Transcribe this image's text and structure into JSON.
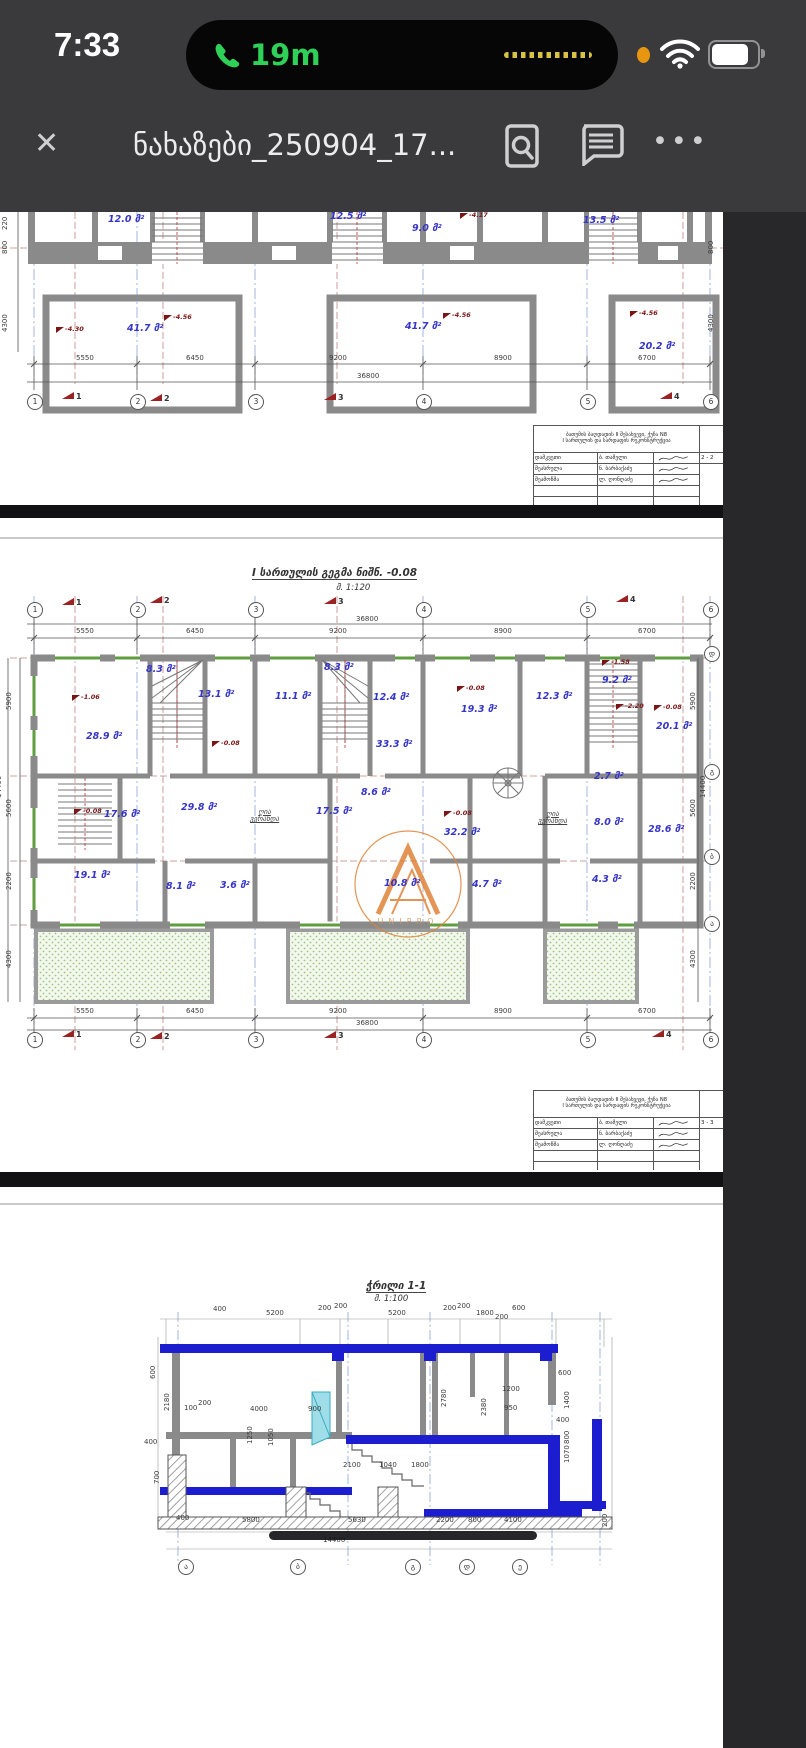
{
  "status_bar": {
    "time": "7:33",
    "call_duration": "19m",
    "call_color": "#2fd058",
    "mic_indicator_color": "#e8960f",
    "battery_level": "76%"
  },
  "toolbar": {
    "close_glyph": "✕",
    "title": "ნახაზები_250904_17...",
    "more_glyph": "•••",
    "icons": [
      "search-in-document",
      "comments",
      "more-options"
    ]
  },
  "viewer": {
    "page_color": "#ffffff",
    "gap_color": "#121214",
    "chrome_color": "#3a3a3c",
    "accent_blue": "#3535c8",
    "wall_gray": "#8a8a8a",
    "window_green": "#5f9e3f",
    "watermark_orange": "#e08238",
    "section_blue": "#1d1dd0"
  },
  "pages": [
    {
      "name": "basement-plan-partial",
      "labels": [
        {
          "k": "area",
          "t": "12.0 მ²",
          "x": 108,
          "y": 3
        },
        {
          "k": "area",
          "t": "12.5 მ²",
          "x": 330,
          "y": 0
        },
        {
          "k": "area",
          "t": "9.0 მ²",
          "x": 412,
          "y": 12
        },
        {
          "k": "area",
          "t": "13.5 მ²",
          "x": 583,
          "y": 4
        },
        {
          "k": "area",
          "t": "41.7 მ²",
          "x": 127,
          "y": 112
        },
        {
          "k": "area",
          "t": "41.7 მ²",
          "x": 405,
          "y": 110
        },
        {
          "k": "area",
          "t": "20.2 მ²",
          "x": 639,
          "y": 130
        },
        {
          "k": "elev",
          "t": "-4.30",
          "x": 56,
          "y": 114
        },
        {
          "k": "elev",
          "t": "-4.56",
          "x": 164,
          "y": 102
        },
        {
          "k": "elev",
          "t": "-4.56",
          "x": 443,
          "y": 100
        },
        {
          "k": "elev",
          "t": "-4.56",
          "x": 630,
          "y": 98
        },
        {
          "k": "elev",
          "t": "-4.17",
          "x": 460,
          "y": 0
        },
        {
          "k": "dim",
          "t": "5550",
          "x": 76,
          "y": 143
        },
        {
          "k": "dim",
          "t": "6450",
          "x": 186,
          "y": 143
        },
        {
          "k": "dim",
          "t": "9200",
          "x": 329,
          "y": 143
        },
        {
          "k": "dim",
          "t": "8900",
          "x": 494,
          "y": 143
        },
        {
          "k": "dim",
          "t": "6700",
          "x": 638,
          "y": 143
        },
        {
          "k": "dim",
          "t": "36800",
          "x": 357,
          "y": 161
        },
        {
          "k": "bub",
          "t": "1",
          "x": 27,
          "y": 182
        },
        {
          "k": "bub",
          "t": "2",
          "x": 130,
          "y": 182
        },
        {
          "k": "bub",
          "t": "3",
          "x": 248,
          "y": 182
        },
        {
          "k": "bub",
          "t": "4",
          "x": 416,
          "y": 182
        },
        {
          "k": "bub",
          "t": "5",
          "x": 580,
          "y": 182
        },
        {
          "k": "bub",
          "t": "6",
          "x": 703,
          "y": 182
        },
        {
          "k": "flag",
          "t": "1",
          "x": 62,
          "y": 180
        },
        {
          "k": "flag",
          "t": "2",
          "x": 150,
          "y": 182
        },
        {
          "k": "flag",
          "t": "3",
          "x": 324,
          "y": 181
        },
        {
          "k": "flag",
          "t": "4",
          "x": 660,
          "y": 180
        },
        {
          "k": "dimv",
          "t": "220",
          "x": 2,
          "y": 18
        },
        {
          "k": "dimv",
          "t": "800",
          "x": 2,
          "y": 42
        },
        {
          "k": "dimv",
          "t": "4300",
          "x": 2,
          "y": 120
        },
        {
          "k": "dimv",
          "t": "800",
          "x": 708,
          "y": 42
        },
        {
          "k": "dimv",
          "t": "4300",
          "x": 708,
          "y": 120
        }
      ]
    },
    {
      "name": "first-floor-plan",
      "watermark": "UNIPRO",
      "labels": [
        {
          "k": "title",
          "t": "I სართულის გეგმა ნიშნ. -0.08",
          "x": 252,
          "y": 50
        },
        {
          "k": "scale",
          "t": "მ. 1:120",
          "x": 336,
          "y": 66
        },
        {
          "k": "flag",
          "t": "1",
          "x": 62,
          "y": 80
        },
        {
          "k": "flag",
          "t": "2",
          "x": 150,
          "y": 78
        },
        {
          "k": "flag",
          "t": "3",
          "x": 324,
          "y": 79
        },
        {
          "k": "flag",
          "t": "4",
          "x": 616,
          "y": 77
        },
        {
          "k": "bub",
          "t": "1",
          "x": 27,
          "y": 84
        },
        {
          "k": "bub",
          "t": "2",
          "x": 130,
          "y": 84
        },
        {
          "k": "bub",
          "t": "3",
          "x": 248,
          "y": 84
        },
        {
          "k": "bub",
          "t": "4",
          "x": 416,
          "y": 84
        },
        {
          "k": "bub",
          "t": "5",
          "x": 580,
          "y": 84
        },
        {
          "k": "bub",
          "t": "6",
          "x": 703,
          "y": 84
        },
        {
          "k": "dim",
          "t": "5550",
          "x": 76,
          "y": 110
        },
        {
          "k": "dim",
          "t": "6450",
          "x": 186,
          "y": 110
        },
        {
          "k": "dim",
          "t": "9200",
          "x": 329,
          "y": 110
        },
        {
          "k": "dim",
          "t": "8900",
          "x": 494,
          "y": 110
        },
        {
          "k": "dim",
          "t": "6700",
          "x": 638,
          "y": 110
        },
        {
          "k": "dim",
          "t": "36800",
          "x": 356,
          "y": 98
        },
        {
          "k": "elev",
          "t": "-1.06",
          "x": 72,
          "y": 176
        },
        {
          "k": "area",
          "t": "28.9 მ²",
          "x": 86,
          "y": 214
        },
        {
          "k": "area",
          "t": "8.3 მ²",
          "x": 146,
          "y": 147
        },
        {
          "k": "area",
          "t": "13.1 მ²",
          "x": 198,
          "y": 172
        },
        {
          "k": "area",
          "t": "11.1 მ²",
          "x": 275,
          "y": 174
        },
        {
          "k": "area",
          "t": "8.3 მ²",
          "x": 324,
          "y": 145
        },
        {
          "k": "area",
          "t": "12.4 მ²",
          "x": 373,
          "y": 175
        },
        {
          "k": "elev",
          "t": "-0.08",
          "x": 457,
          "y": 167
        },
        {
          "k": "area",
          "t": "19.3 მ²",
          "x": 461,
          "y": 187
        },
        {
          "k": "area",
          "t": "12.3 მ²",
          "x": 536,
          "y": 174
        },
        {
          "k": "elev",
          "t": "-1.58",
          "x": 602,
          "y": 141
        },
        {
          "k": "area",
          "t": "9.2 მ²",
          "x": 602,
          "y": 158
        },
        {
          "k": "elev",
          "t": "-2.20",
          "x": 616,
          "y": 185
        },
        {
          "k": "elev",
          "t": "-0.08",
          "x": 654,
          "y": 186
        },
        {
          "k": "area",
          "t": "20.1 მ²",
          "x": 656,
          "y": 204
        },
        {
          "k": "area",
          "t": "33.3 მ²",
          "x": 376,
          "y": 222
        },
        {
          "k": "elev",
          "t": "-0.08",
          "x": 212,
          "y": 222
        },
        {
          "k": "elev",
          "t": "-0.08",
          "x": 74,
          "y": 290
        },
        {
          "k": "area",
          "t": "17.6 მ²",
          "x": 104,
          "y": 292
        },
        {
          "k": "area",
          "t": "29.8 მ²",
          "x": 181,
          "y": 285
        },
        {
          "k": "area",
          "t": "17.5 მ²",
          "x": 316,
          "y": 289
        },
        {
          "k": "area",
          "t": "8.6 მ²",
          "x": 361,
          "y": 270
        },
        {
          "k": "elev",
          "t": "-0.08",
          "x": 444,
          "y": 292
        },
        {
          "k": "area",
          "t": "32.2 მ²",
          "x": 444,
          "y": 310
        },
        {
          "k": "note",
          "t": "ღია\nვერანდა",
          "x": 250,
          "y": 291
        },
        {
          "k": "note",
          "t": "ღია\nვერანდა",
          "x": 538,
          "y": 293
        },
        {
          "k": "area",
          "t": "2.7 მ²",
          "x": 594,
          "y": 254
        },
        {
          "k": "area",
          "t": "8.0 მ²",
          "x": 594,
          "y": 300
        },
        {
          "k": "area",
          "t": "28.6 მ²",
          "x": 648,
          "y": 307
        },
        {
          "k": "area",
          "t": "19.1 მ²",
          "x": 74,
          "y": 353
        },
        {
          "k": "area",
          "t": "8.1 მ²",
          "x": 166,
          "y": 364
        },
        {
          "k": "area",
          "t": "3.6 მ²",
          "x": 220,
          "y": 363
        },
        {
          "k": "area",
          "t": "10.8 მ²",
          "x": 384,
          "y": 361
        },
        {
          "k": "area",
          "t": "4.7 მ²",
          "x": 472,
          "y": 362
        },
        {
          "k": "area",
          "t": "4.3 მ²",
          "x": 592,
          "y": 357
        },
        {
          "k": "dim",
          "t": "5550",
          "x": 76,
          "y": 490
        },
        {
          "k": "dim",
          "t": "6450",
          "x": 186,
          "y": 490
        },
        {
          "k": "dim",
          "t": "9200",
          "x": 329,
          "y": 490
        },
        {
          "k": "dim",
          "t": "8900",
          "x": 494,
          "y": 490
        },
        {
          "k": "dim",
          "t": "6700",
          "x": 638,
          "y": 490
        },
        {
          "k": "dim",
          "t": "36800",
          "x": 356,
          "y": 502
        },
        {
          "k": "bub",
          "t": "1",
          "x": 27,
          "y": 514
        },
        {
          "k": "bub",
          "t": "2",
          "x": 130,
          "y": 514
        },
        {
          "k": "bub",
          "t": "3",
          "x": 248,
          "y": 514
        },
        {
          "k": "bub",
          "t": "4",
          "x": 416,
          "y": 514
        },
        {
          "k": "bub",
          "t": "5",
          "x": 580,
          "y": 514
        },
        {
          "k": "bub",
          "t": "6",
          "x": 703,
          "y": 514
        },
        {
          "k": "flag",
          "t": "1",
          "x": 62,
          "y": 512
        },
        {
          "k": "flag",
          "t": "2",
          "x": 150,
          "y": 514
        },
        {
          "k": "flag",
          "t": "3",
          "x": 324,
          "y": 513
        },
        {
          "k": "flag",
          "t": "4",
          "x": 652,
          "y": 512
        },
        {
          "k": "dimv",
          "t": "5900",
          "x": 6,
          "y": 192
        },
        {
          "k": "dimv",
          "t": "14400",
          "x": -4,
          "y": 280
        },
        {
          "k": "dimv",
          "t": "5600",
          "x": 6,
          "y": 299
        },
        {
          "k": "dimv",
          "t": "2200",
          "x": 6,
          "y": 372
        },
        {
          "k": "dimv",
          "t": "4300",
          "x": 6,
          "y": 450
        },
        {
          "k": "dimv",
          "t": "5900",
          "x": 690,
          "y": 192
        },
        {
          "k": "dimv",
          "t": "14400",
          "x": 700,
          "y": 280
        },
        {
          "k": "dimv",
          "t": "5600",
          "x": 690,
          "y": 299
        },
        {
          "k": "dimv",
          "t": "2200",
          "x": 690,
          "y": 372
        },
        {
          "k": "dimv",
          "t": "4300",
          "x": 690,
          "y": 450
        },
        {
          "k": "bub",
          "t": "დ",
          "x": 704,
          "y": 128
        },
        {
          "k": "bub",
          "t": "გ",
          "x": 704,
          "y": 246
        },
        {
          "k": "bub",
          "t": "ბ",
          "x": 704,
          "y": 331
        },
        {
          "k": "bub",
          "t": "ა",
          "x": 704,
          "y": 398
        }
      ]
    },
    {
      "name": "section-1-1",
      "labels": [
        {
          "k": "title",
          "t": "ჭრილი 1-1",
          "x": 366,
          "y": 94
        },
        {
          "k": "scale",
          "t": "მ. 1:100",
          "x": 374,
          "y": 108
        },
        {
          "k": "dim",
          "t": "400",
          "x": 213,
          "y": 119
        },
        {
          "k": "dim",
          "t": "5200",
          "x": 266,
          "y": 123
        },
        {
          "k": "dim",
          "t": "200",
          "x": 318,
          "y": 118
        },
        {
          "k": "dim",
          "t": "200",
          "x": 334,
          "y": 116
        },
        {
          "k": "dim",
          "t": "5200",
          "x": 388,
          "y": 123
        },
        {
          "k": "dim",
          "t": "200",
          "x": 443,
          "y": 118
        },
        {
          "k": "dim",
          "t": "200",
          "x": 457,
          "y": 116
        },
        {
          "k": "dim",
          "t": "1800",
          "x": 476,
          "y": 123
        },
        {
          "k": "dim",
          "t": "200",
          "x": 495,
          "y": 127
        },
        {
          "k": "dim",
          "t": "600",
          "x": 512,
          "y": 118
        },
        {
          "k": "dimv",
          "t": "600",
          "x": 150,
          "y": 192
        },
        {
          "k": "dimv",
          "t": "2180",
          "x": 164,
          "y": 224
        },
        {
          "k": "dim",
          "t": "100",
          "x": 184,
          "y": 218
        },
        {
          "k": "dim",
          "t": "200",
          "x": 198,
          "y": 213
        },
        {
          "k": "dim",
          "t": "4000",
          "x": 250,
          "y": 219
        },
        {
          "k": "dim",
          "t": "900",
          "x": 308,
          "y": 219
        },
        {
          "k": "dimv",
          "t": "1250",
          "x": 247,
          "y": 257
        },
        {
          "k": "dimv",
          "t": "1050",
          "x": 268,
          "y": 259
        },
        {
          "k": "dim",
          "t": "400",
          "x": 144,
          "y": 252
        },
        {
          "k": "dimv",
          "t": "700",
          "x": 154,
          "y": 297
        },
        {
          "k": "dimv",
          "t": "2780",
          "x": 441,
          "y": 220
        },
        {
          "k": "dimv",
          "t": "2380",
          "x": 481,
          "y": 229
        },
        {
          "k": "dim",
          "t": "1200",
          "x": 502,
          "y": 199
        },
        {
          "k": "dim",
          "t": "950",
          "x": 504,
          "y": 218
        },
        {
          "k": "dim",
          "t": "2100",
          "x": 343,
          "y": 275
        },
        {
          "k": "dim",
          "t": "1040",
          "x": 379,
          "y": 275
        },
        {
          "k": "dim",
          "t": "1800",
          "x": 411,
          "y": 275
        },
        {
          "k": "dim",
          "t": "600",
          "x": 558,
          "y": 183
        },
        {
          "k": "dimv",
          "t": "1400",
          "x": 564,
          "y": 222
        },
        {
          "k": "dim",
          "t": "400",
          "x": 556,
          "y": 230
        },
        {
          "k": "dimv",
          "t": "800",
          "x": 564,
          "y": 257
        },
        {
          "k": "dimv",
          "t": "1070",
          "x": 564,
          "y": 276
        },
        {
          "k": "dimv",
          "t": "200",
          "x": 602,
          "y": 340
        },
        {
          "k": "dim",
          "t": "400",
          "x": 176,
          "y": 328
        },
        {
          "k": "dim",
          "t": "5800",
          "x": 242,
          "y": 330
        },
        {
          "k": "dim",
          "t": "5630",
          "x": 348,
          "y": 330
        },
        {
          "k": "dim",
          "t": "2200",
          "x": 436,
          "y": 330
        },
        {
          "k": "dim",
          "t": "800",
          "x": 468,
          "y": 330
        },
        {
          "k": "dim",
          "t": "4100",
          "x": 504,
          "y": 330
        },
        {
          "k": "dim",
          "t": "14400",
          "x": 323,
          "y": 350
        },
        {
          "k": "bub",
          "t": "ა",
          "x": 178,
          "y": 372
        },
        {
          "k": "bub",
          "t": "ბ",
          "x": 290,
          "y": 372
        },
        {
          "k": "bub",
          "t": "გ",
          "x": 405,
          "y": 372
        },
        {
          "k": "bub",
          "t": "დ",
          "x": 459,
          "y": 372
        },
        {
          "k": "bub",
          "t": "ე",
          "x": 512,
          "y": 372
        }
      ]
    }
  ],
  "title_blocks": [
    {
      "project_line1": "ბათუმის ბაღდადის II შესახვევი, ქუჩა N8",
      "project_line2": "I სართულის და სარდაფის რეკონსტრუქცია",
      "rows": [
        {
          "role": "დამკვეთი",
          "name": "ბ. თამელი"
        },
        {
          "role": "შეასრულა",
          "name": "ნ. ბარბაქაძე"
        },
        {
          "role": "შეამოწმა",
          "name": "ლ. ღონღაძე"
        }
      ],
      "sheet_title": "სარდაფის გეგმა ნიშნ. -3.50",
      "meta": [
        "2 - 2",
        "32",
        "1:120"
      ],
      "company": "შ.პ.ს. «უნიპრო»"
    },
    {
      "project_line1": "ბათუმის ბაღდადის II შესახვევი, ქუჩა N8",
      "project_line2": "I სართულის და სარდაფის რეკონსტრუქცია",
      "rows": [
        {
          "role": "დამკვეთი",
          "name": "ბ. თამელი"
        },
        {
          "role": "შეასრულა",
          "name": "ნ. ბარბაქაძე"
        },
        {
          "role": "შეამოწმა",
          "name": "ლ. ღონღაძე"
        }
      ],
      "sheet_title": "I სართულის გეგმა ნიშნ. -0.08",
      "meta": [
        "3 - 3",
        "32",
        "1:120"
      ],
      "company": "შ.პ.ს. «უნიპრო»"
    }
  ]
}
